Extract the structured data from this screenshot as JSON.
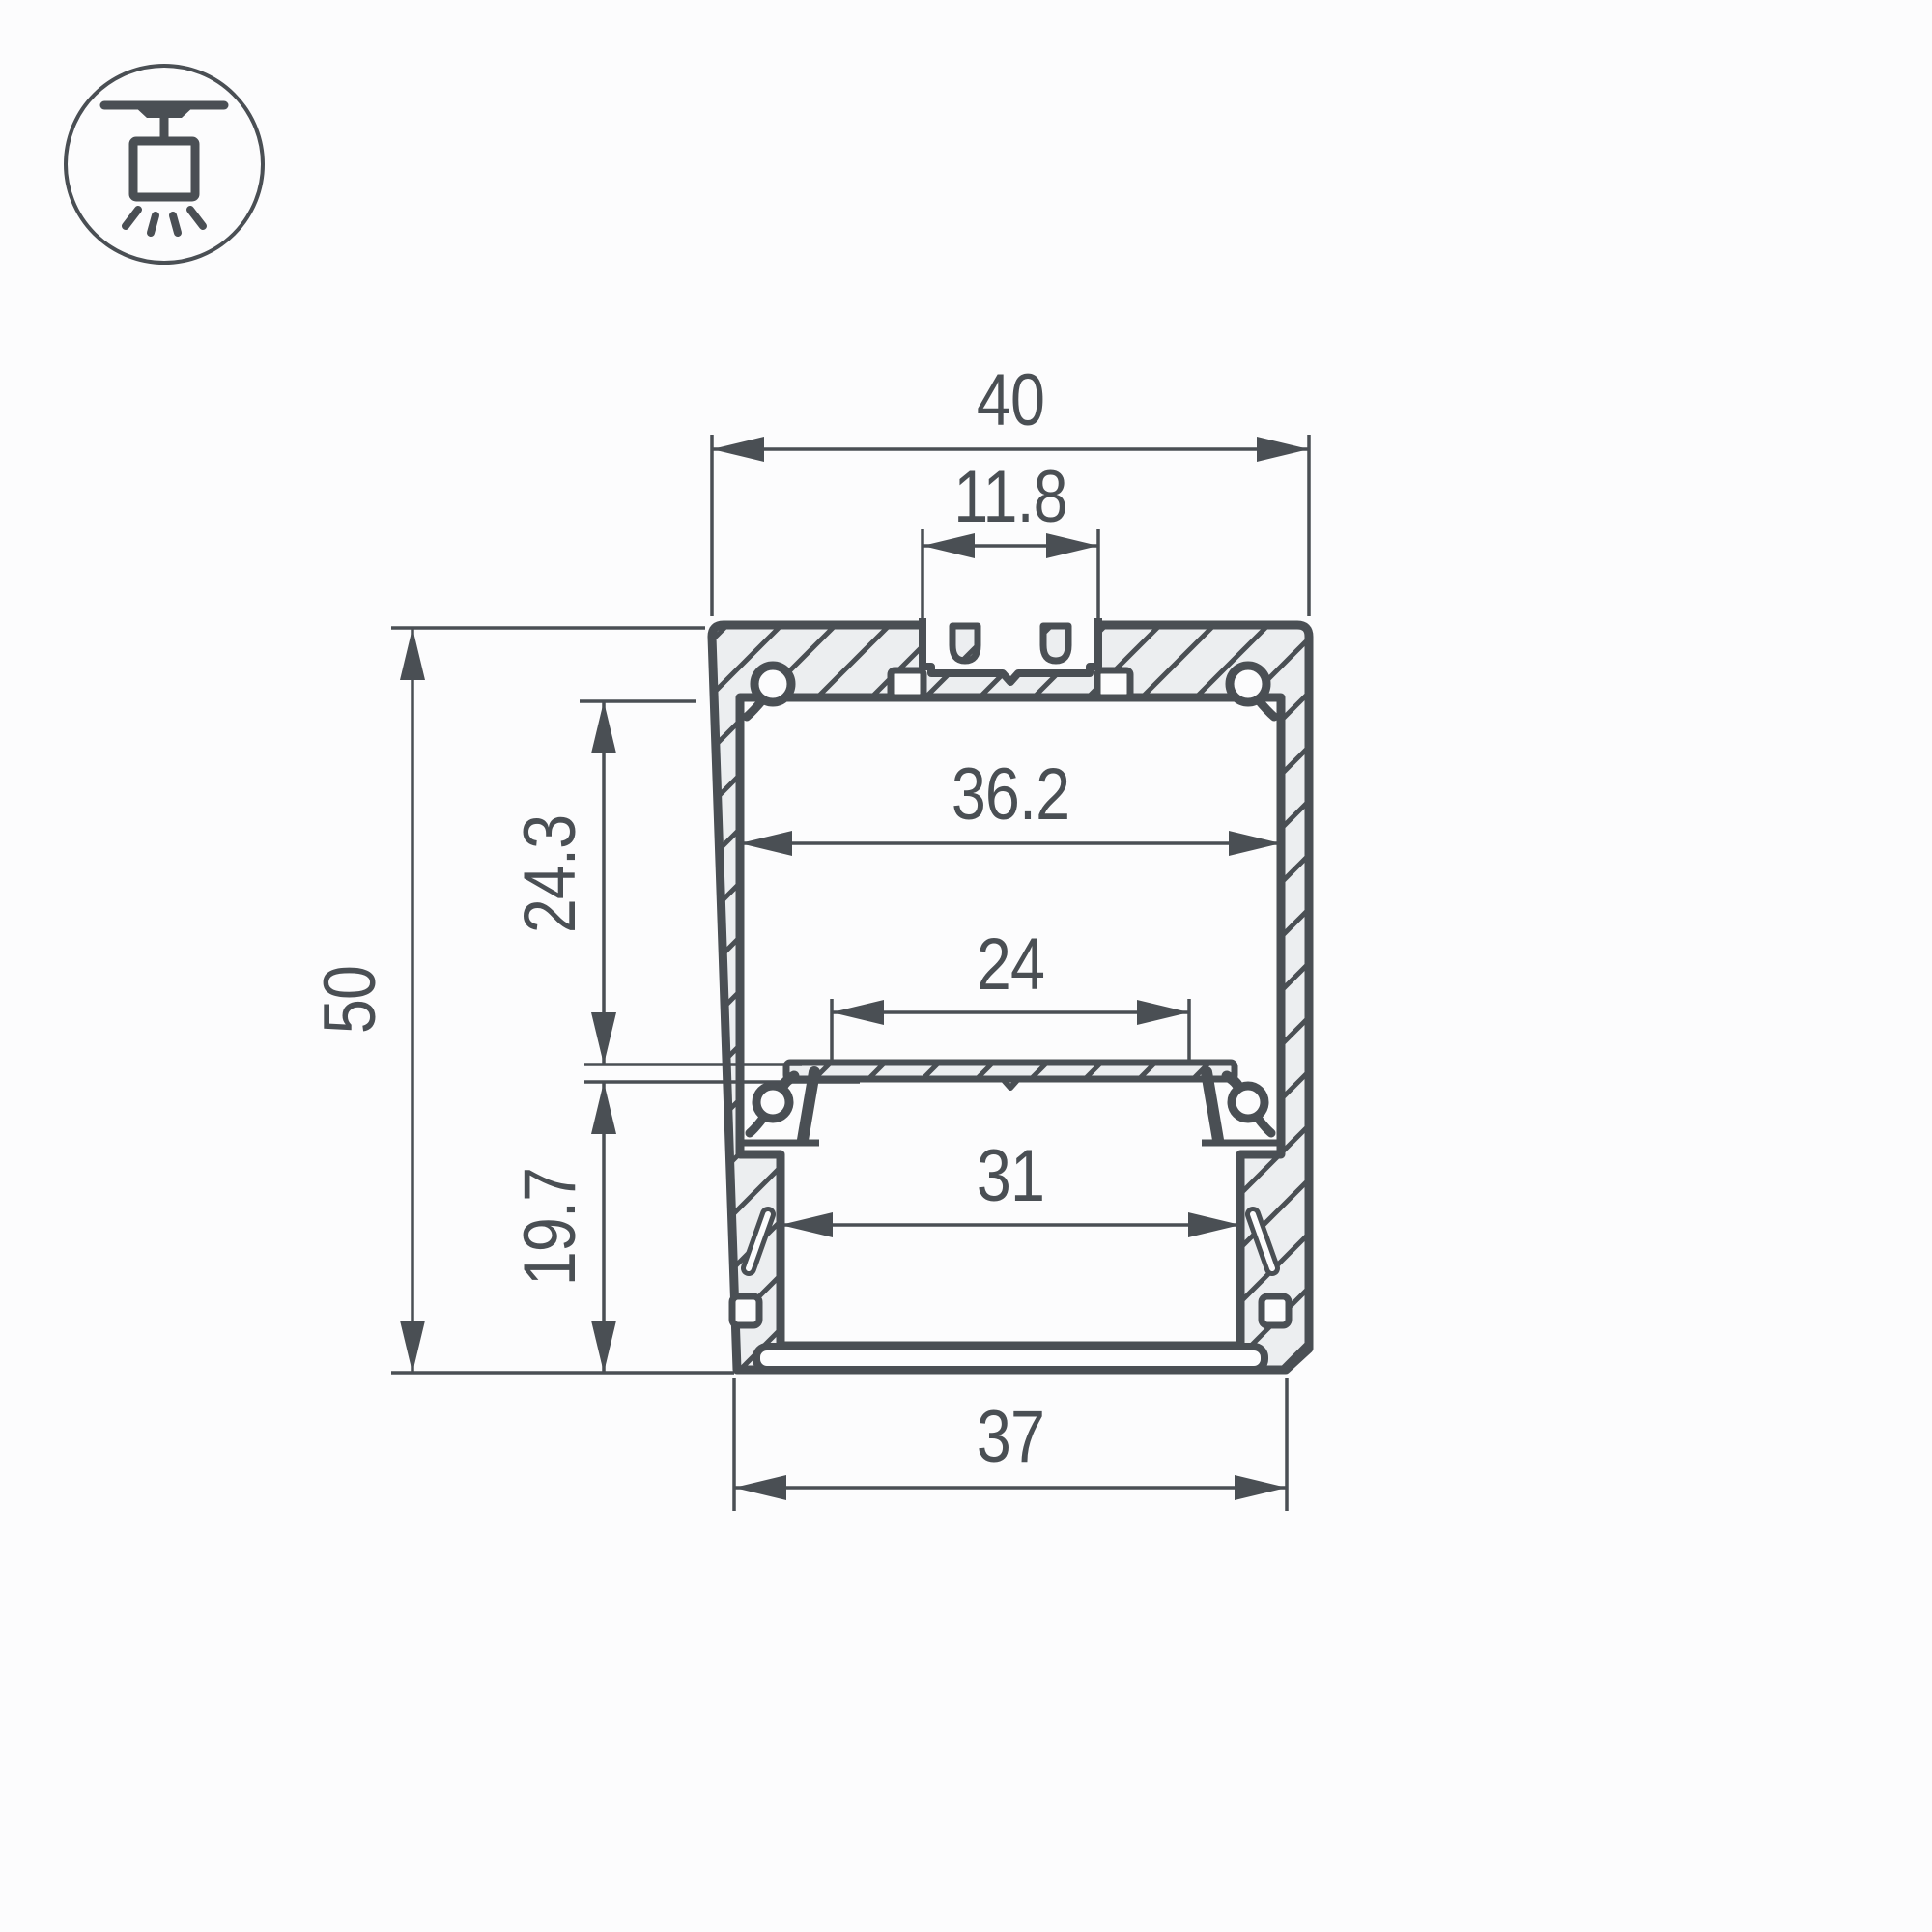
{
  "title": "LED profile cross-section drawing",
  "icon": {
    "name": "suspended-ceiling-mount-icon",
    "description": "pendant luminaire hanging from ceiling with light rays"
  },
  "dimensions": {
    "overall_width": {
      "label": "40"
    },
    "top_slot_width": {
      "label": "11.8"
    },
    "inner_width": {
      "label": "36.2"
    },
    "upper_cavity_height": {
      "label": "24.3"
    },
    "led_plate_width": {
      "label": "24"
    },
    "overall_height": {
      "label": "50"
    },
    "lower_cavity_height": {
      "label": "19.7"
    },
    "lower_inner_width": {
      "label": "31"
    },
    "bottom_width": {
      "label": "37"
    }
  },
  "colors": {
    "ink": "#4a4f54",
    "aluminum_fill": "#eceef0",
    "background": "#fcfcfd"
  }
}
